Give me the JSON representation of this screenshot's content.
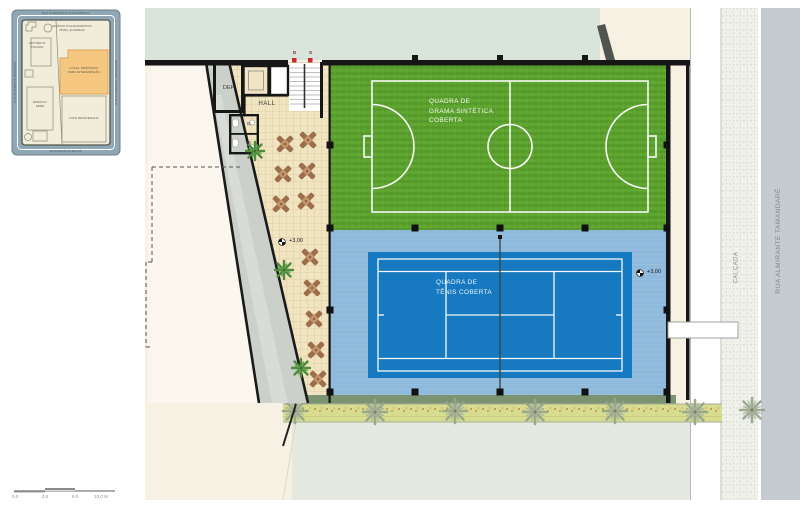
{
  "inset_map": {
    "street_top": "RUA ALMIRANTE ALEXANDRINO",
    "street_bottom": "RUA ESTÁCIO DE SÁ",
    "street_left": "RUA ALMIRANTE BARROSO",
    "street_right": "RUA ALMIRANTE TAMANDARÉ",
    "label_gym": "GINÁSIO POLIESPORTIVO\nNÍVEL QUADRAS",
    "label_changing": "VESTIÁRIOS\nPISCINAS",
    "label_site": "LOCAL PROPOSTO\nPARA INTERVENÇÃO",
    "label_office": "EDIFÍCIO\nSEDE",
    "label_lot": "LOTE RESIDENCIAL"
  },
  "plan": {
    "room_dep": "DEP.",
    "room_hall": "HALL",
    "room_is_1": "IS",
    "room_is_2": "IS",
    "stair_down": "D",
    "stair_up": "S",
    "level_terrace": "+3,00",
    "level_court": "+3,00",
    "court_grass": "QUADRA DE\nGRAMA SINTÉTICA\nCOBERTA",
    "court_tennis": "QUADRA DE\nTÊNIS COBERTA",
    "sidewalk": "CALÇADA",
    "street": "RUA ALMIRANTE TAMANDARÉ"
  },
  "scale_bar": {
    "tick_0": "0,0",
    "tick_1": "3,0",
    "tick_2": "6,0",
    "tick_3": "10,0 M"
  },
  "colors": {
    "grass": "#5CA22E",
    "tennis_court": "#1779BF",
    "tennis_surround": "#90BADB",
    "site_highlight": "#F6C781",
    "paving": "#F0E4C1",
    "street": "#C5CBD0",
    "plan_background": "#F7F1E3"
  }
}
